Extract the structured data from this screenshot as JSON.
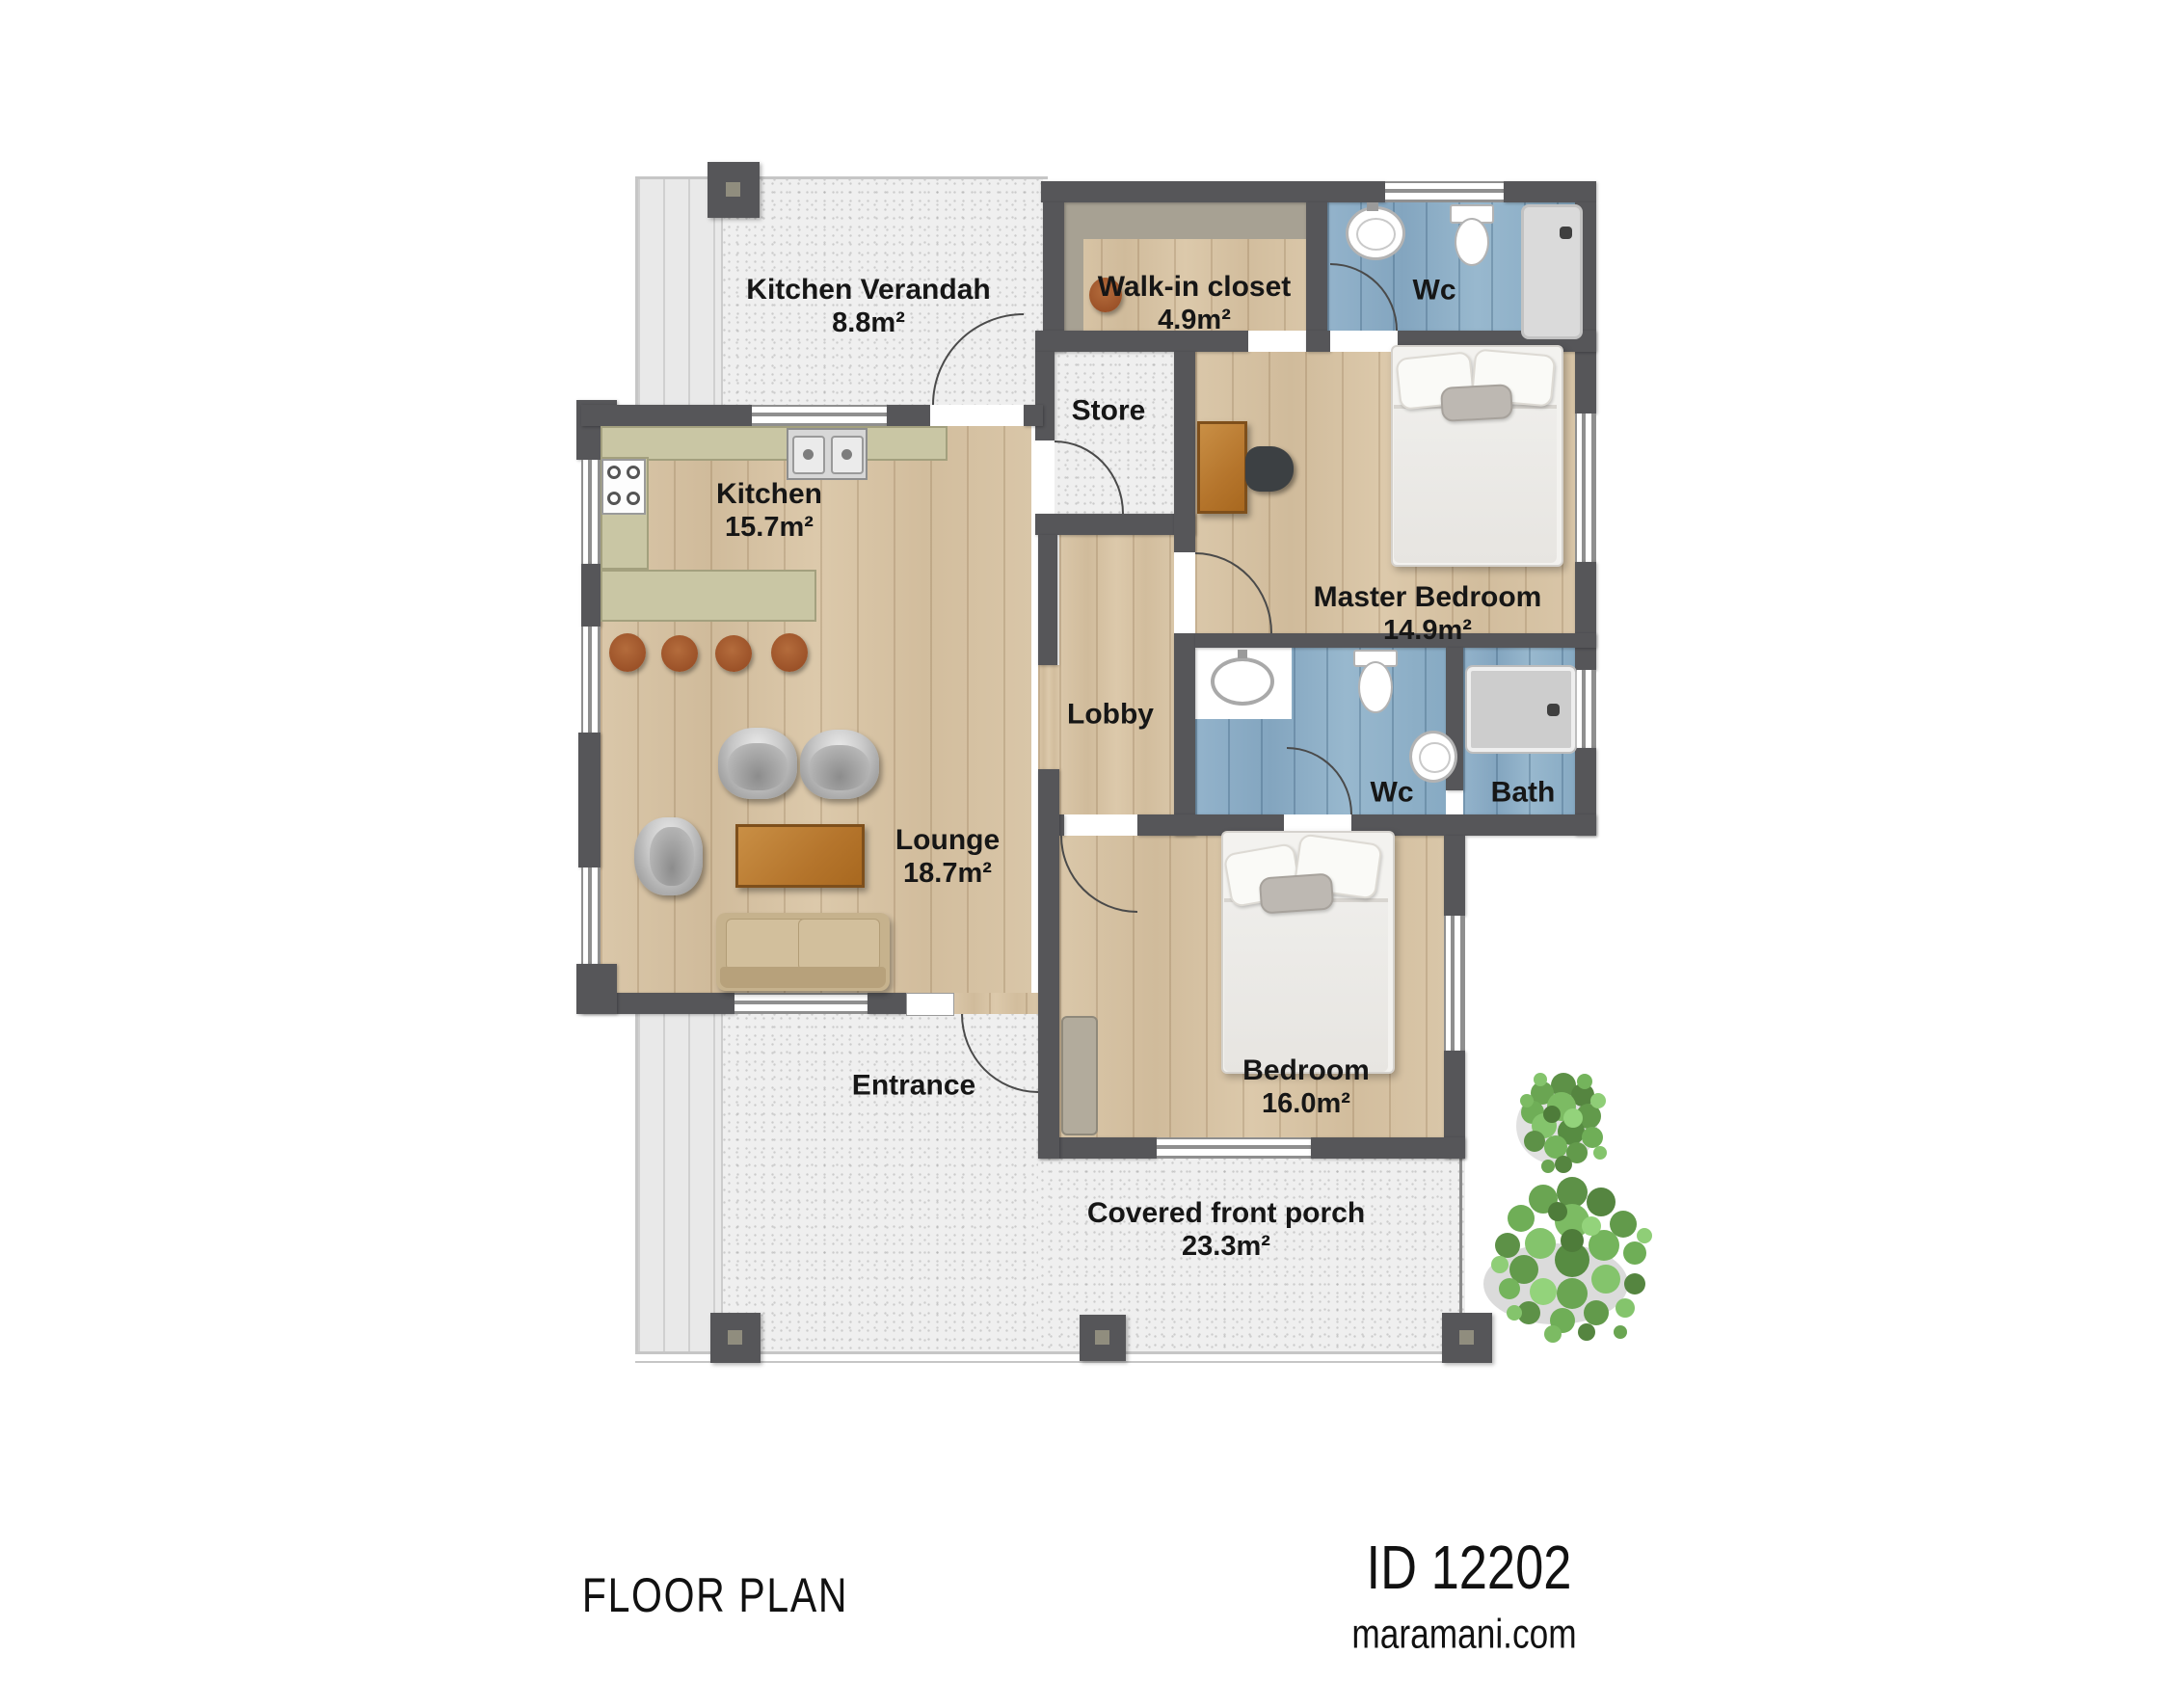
{
  "sheet": {
    "title": "FLOOR PLAN",
    "plan_id": "ID 12202",
    "website": "maramani.com"
  },
  "rooms": {
    "kitchen_verandah": {
      "name": "Kitchen Verandah",
      "area": "8.8m²"
    },
    "walk_in_closet": {
      "name": "Walk-in closet",
      "area": "4.9m²"
    },
    "wc_top": {
      "name": "Wc"
    },
    "store": {
      "name": "Store"
    },
    "kitchen": {
      "name": "Kitchen",
      "area": "15.7m²"
    },
    "master_bedroom": {
      "name": "Master Bedroom",
      "area": "14.9m²"
    },
    "lobby": {
      "name": "Lobby"
    },
    "wc_mid": {
      "name": "Wc"
    },
    "bath": {
      "name": "Bath"
    },
    "lounge": {
      "name": "Lounge",
      "area": "18.7m²"
    },
    "entrance": {
      "name": "Entrance"
    },
    "bedroom": {
      "name": "Bedroom",
      "area": "16.0m²"
    },
    "covered_front_porch": {
      "name": "Covered front porch",
      "area": "23.3m²"
    }
  },
  "colors": {
    "wall": "#565659",
    "wood_floor": "#d5c1a3",
    "bathroom_floor": "#8badc7",
    "concrete": "#efefef",
    "kitchen_counter": "#c9c6a4",
    "accent_wood": "#bf7a35",
    "sofa": "#c6b392",
    "plant": "#679d4d",
    "label_text": "#161616"
  }
}
